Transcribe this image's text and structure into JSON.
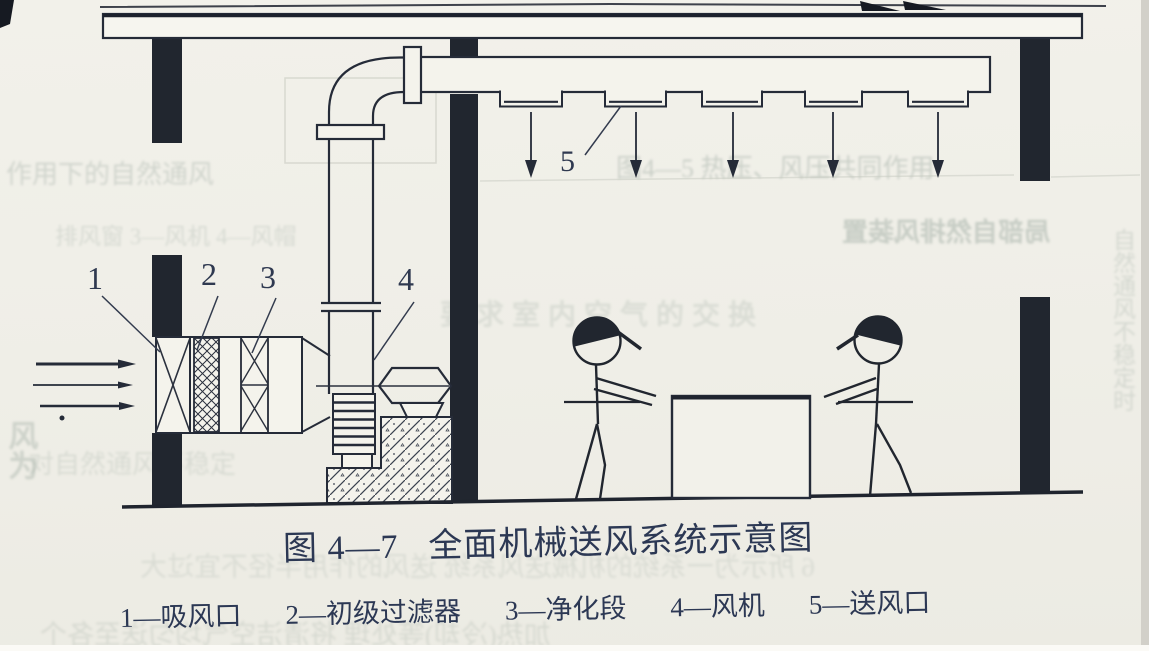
{
  "figure": {
    "caption_number": "图 4—7",
    "caption_title": "全面机械送风系统示意图",
    "dash": "—",
    "legend": [
      {
        "num": "1",
        "label": "吸风口"
      },
      {
        "num": "2",
        "label": "初级过滤器"
      },
      {
        "num": "3",
        "label": "净化段"
      },
      {
        "num": "4",
        "label": "风机"
      },
      {
        "num": "5",
        "label": "送风口"
      }
    ]
  },
  "ghost": {
    "items": [
      {
        "text": "作用下的自然通风"
      },
      {
        "text": "图4—5 热压、风压共同作用"
      },
      {
        "text": "排风窗 3—风机 4—风帽"
      },
      {
        "text": "局部自然排风装置"
      },
      {
        "text": "要求室内空气的交换"
      },
      {
        "text": "对自然通风不稳定"
      },
      {
        "text": "风为"
      },
      {
        "text": "6 所示为一系统的机械送风系统 送风的作用半径不宜过大"
      },
      {
        "text": "加热(冷却)等处理 将清洁空气均匀送至各个"
      },
      {
        "text": "自然通风不稳定时"
      }
    ]
  }
}
